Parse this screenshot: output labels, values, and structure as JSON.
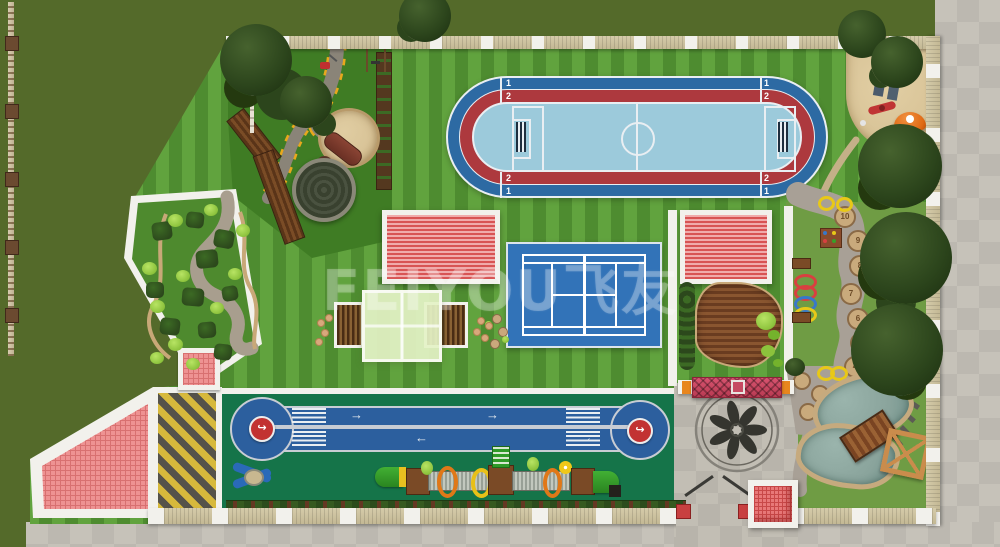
{
  "site": {
    "name": "kindergarten-outdoor-site-plan"
  },
  "watermark": {
    "text": "FEIYOU飞友"
  },
  "oval_track": {
    "lane1": "1",
    "lane2": "2"
  },
  "sprint_track": {
    "arrow_right": "→",
    "arrow_left": "←",
    "turn_glyph": "↪"
  },
  "number_path": {
    "labels": [
      "10",
      "9",
      "8",
      "7",
      "6",
      "5",
      "4"
    ]
  },
  "colors": {
    "outside_grass": "#546a2a",
    "lawn_light": "#61a33e",
    "lawn_dark": "#4e8c30",
    "play_lawn": "#3f7c24",
    "right_lawn": "#6f9c44",
    "field_green": "#157449",
    "track_blue": "#2c5f9e",
    "oval_blue": "#2d6aa3",
    "oval_red": "#ad393e",
    "infield_blue": "#9ccadb",
    "court_blue": "#3273b8",
    "roof_red_dark": "#d85454",
    "roof_red_light": "#f0abab",
    "sand": "#d9c498",
    "path_grey": "#a49c8c",
    "plaza_grey": "#c2beb4",
    "pavement_grey": "#c6c2b9",
    "deck_brown": "#7a4526",
    "pink_tile": "#ee9292",
    "pink_grid": "#d87070",
    "ramp_yellow": "#d7b93c",
    "ramp_dark": "#55524a",
    "wall_tan": "#d5cbaa",
    "post_white": "#f2f1ec",
    "water": "#8aa49c",
    "bush_light": "#9ed44a",
    "hedge_dark": "#2c481c",
    "accent_orange": "#e8861e",
    "sign_red": "#c23232",
    "white_line": "#e9eef2"
  }
}
